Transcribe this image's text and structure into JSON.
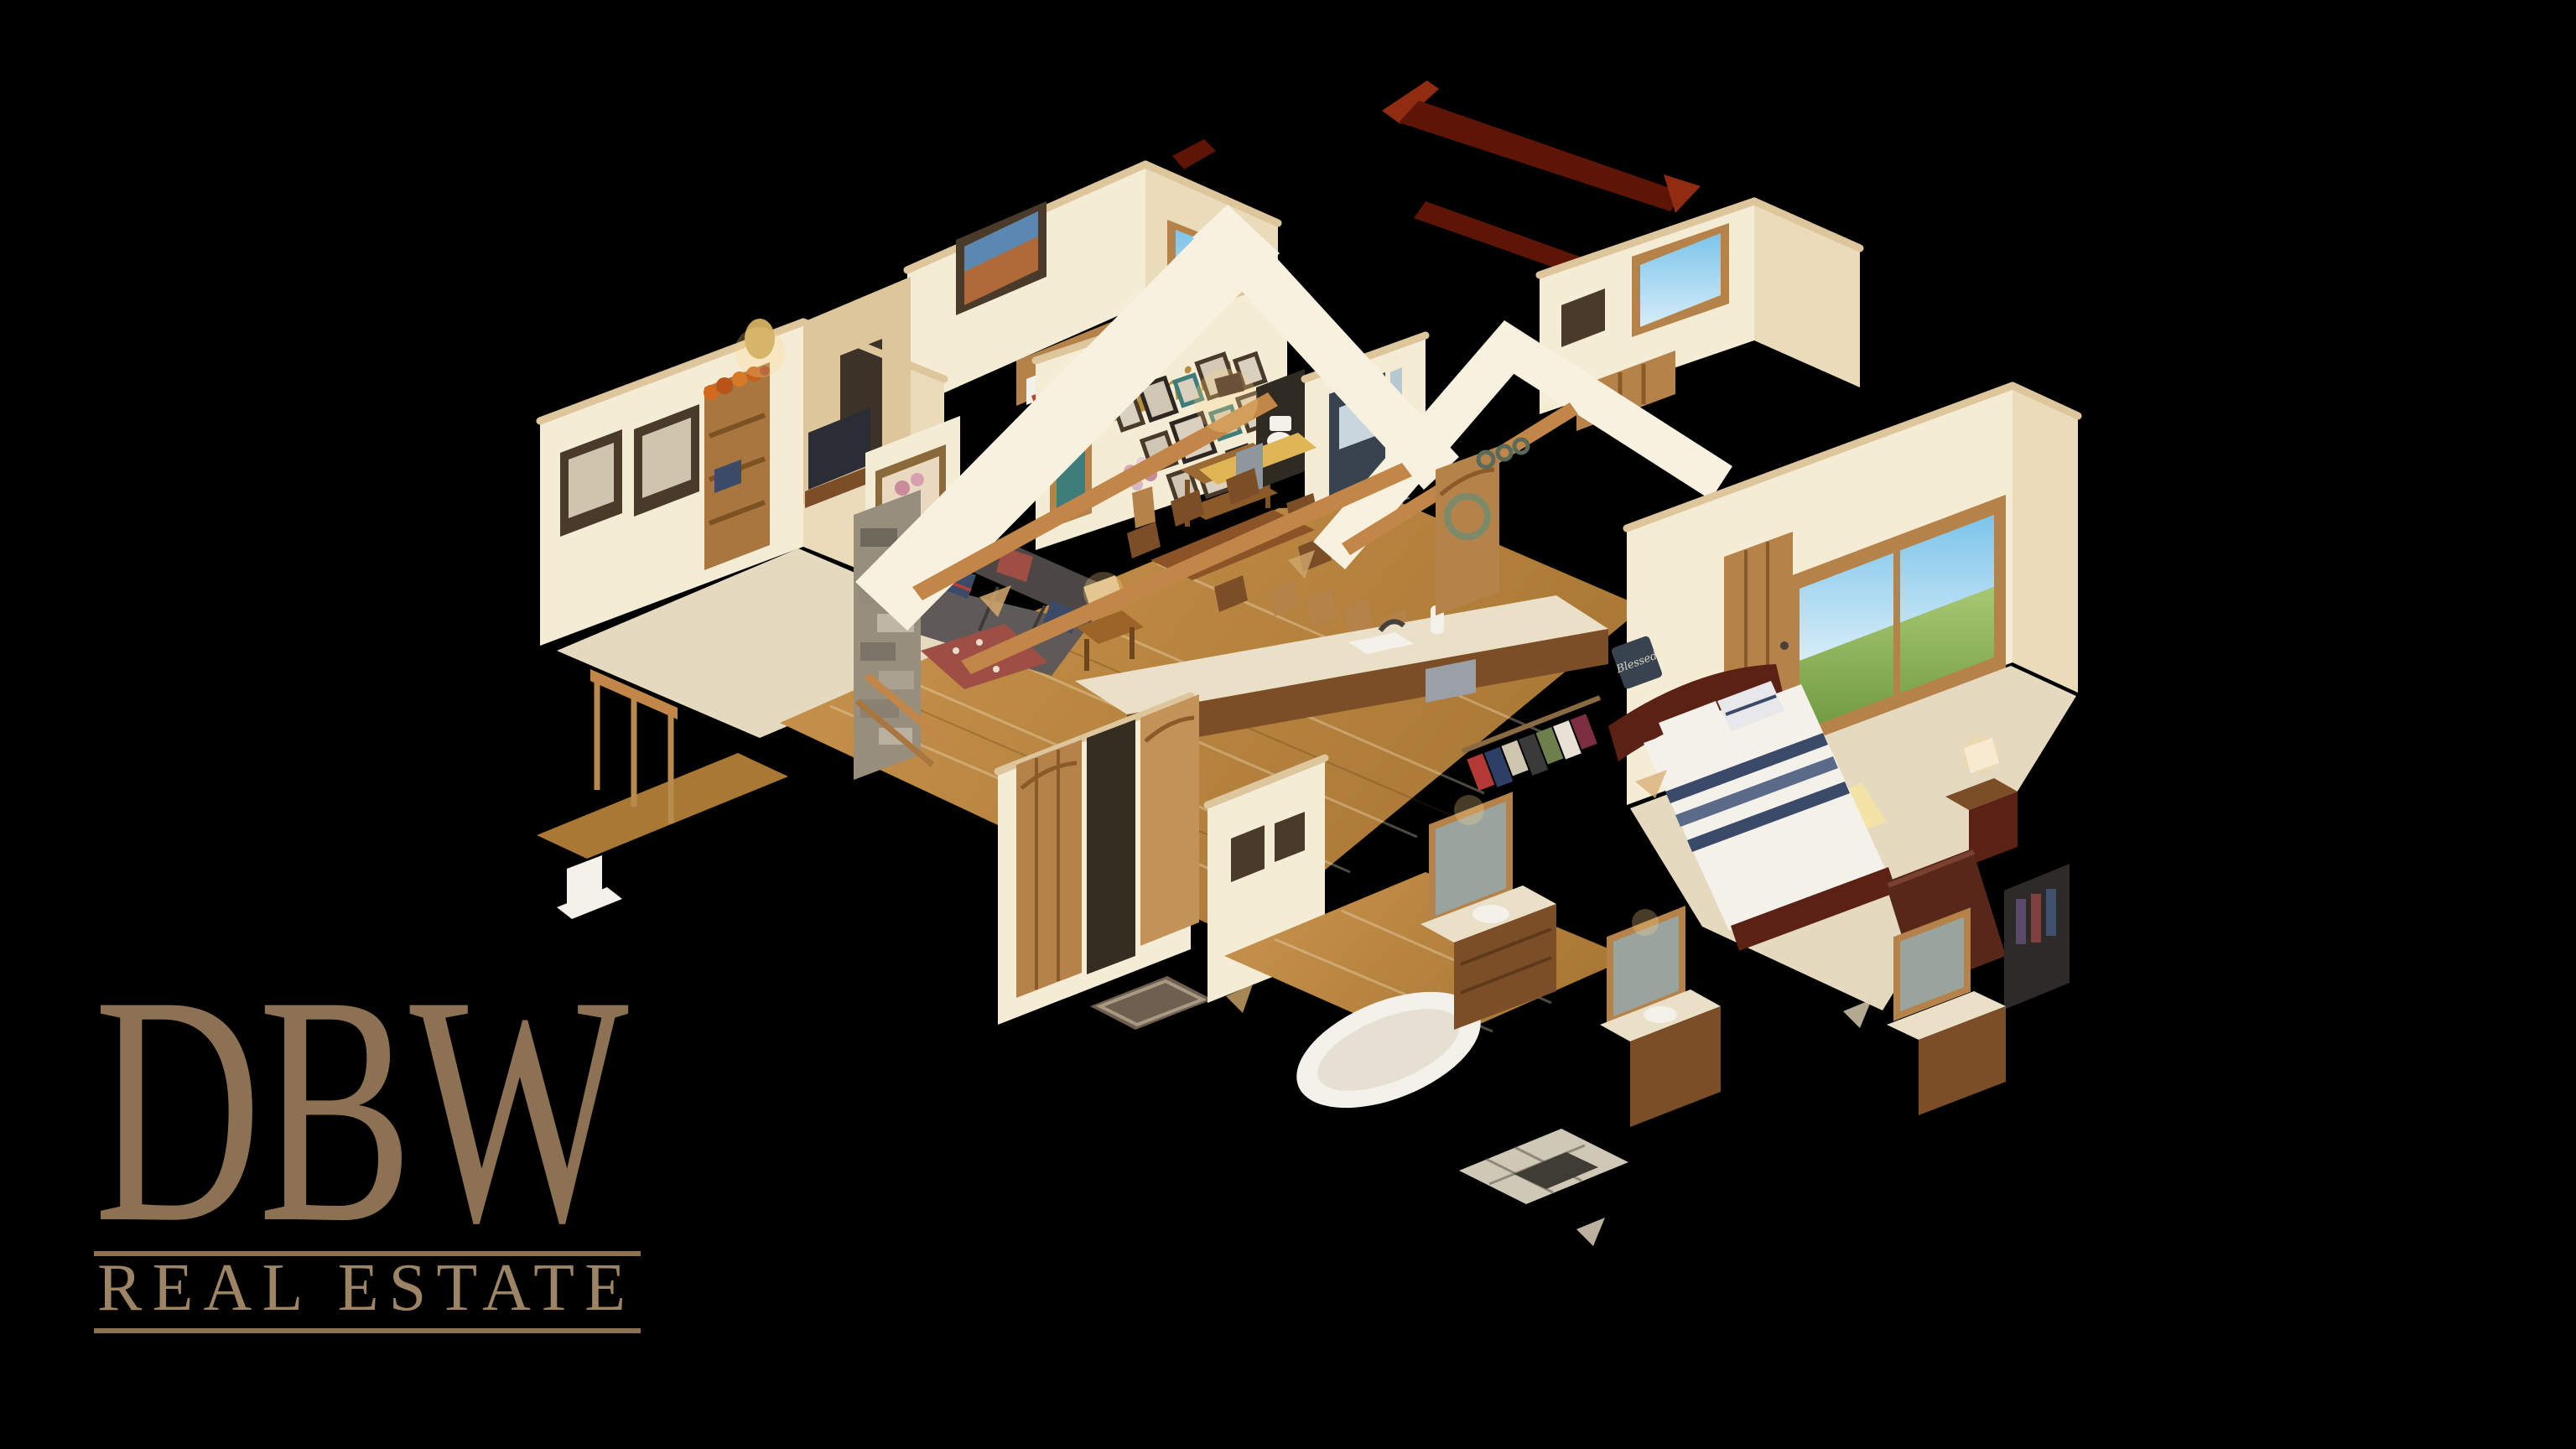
{
  "brand": {
    "monogram": "DBW",
    "wordmark": "REAL ESTATE"
  },
  "scene": {
    "family_wall_script": "Family",
    "blessed_sign": "Blessed"
  },
  "colors": {
    "bg": "#000000",
    "bronze": "#8c7152",
    "bronze_light": "#9c8464",
    "wall": "#f5ecd6",
    "wall_shade": "#eadcba",
    "wall_dark": "#ddc69c",
    "gable": "#f8f1df",
    "floor_wood": "#c9944f",
    "floor_wood_dark": "#a97834",
    "carpet": "#e5dabf",
    "beam": "#c28748",
    "roof_red": "#5e1505",
    "roof_red_bright": "#8f2c12",
    "sofa": "#5f5a58",
    "sofa_dark": "#4c4744",
    "ottoman": "#9e4e44",
    "stone": "#988e7c",
    "wood_door": "#b5834a",
    "wood_dark": "#7c4e28",
    "granite": "#eadfc7",
    "bed_frame": "#5c2115",
    "navy": "#3a4a68",
    "gold": "#b58d3e",
    "white_soft": "#f4f1ea",
    "slate": "#39434f",
    "mirror": "#9aa49e",
    "frame_dark": "#493a2a",
    "teal": "#3f7d7a",
    "mat": "#6e5f4e",
    "sky_top": "#7cc4ea",
    "sky_bottom": "#d6edf8",
    "grass_top": "#a7c873",
    "grass_bottom": "#6f9a40"
  }
}
